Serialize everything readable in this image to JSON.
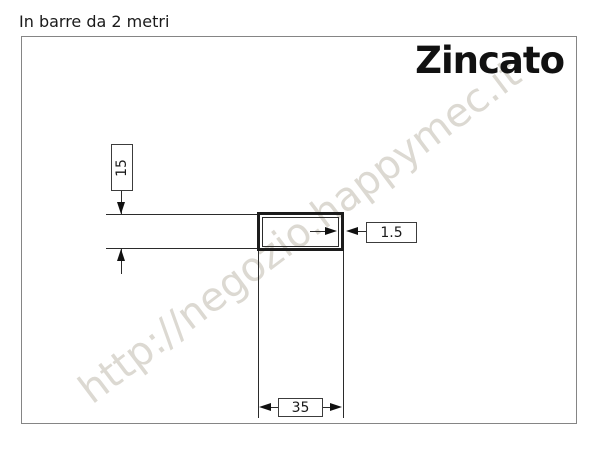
{
  "header": {
    "note": "In barre da 2 metri"
  },
  "drawing": {
    "finish_label": "Zincato",
    "watermark": "http://negozio.happymec.it",
    "type": "rectangular-tube-cross-section",
    "dimensions": {
      "height_mm": "15",
      "thickness_mm": "1.5",
      "width_mm": "35"
    }
  },
  "colors": {
    "line": "#2b2b2b",
    "frame_border": "#858585",
    "text": "#1a1a1a",
    "watermark": "#dcd9d2",
    "background": "#ffffff"
  }
}
